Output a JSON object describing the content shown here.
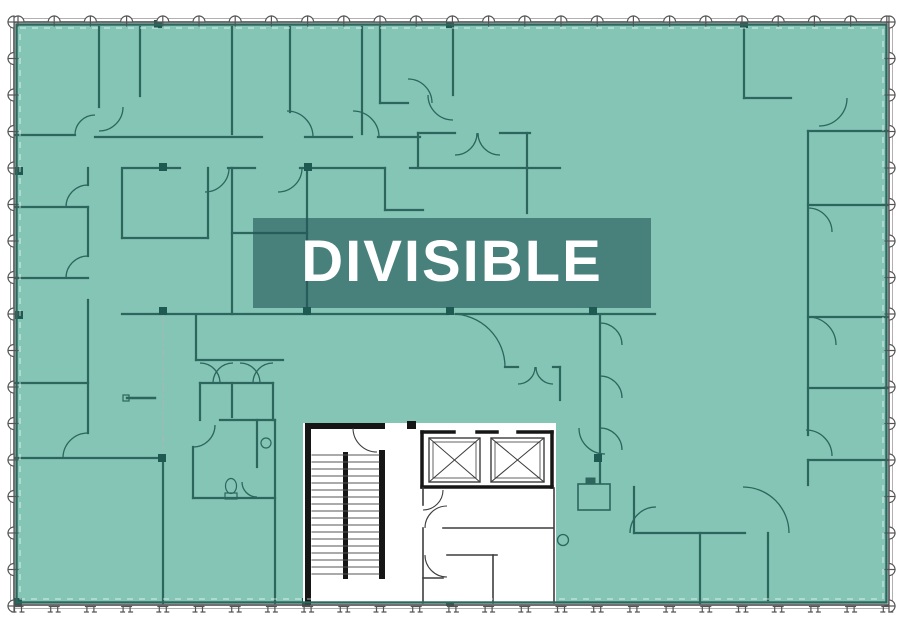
{
  "label": {
    "text": "DIVISIBLE",
    "x": 253,
    "y": 218,
    "w": 398,
    "h": 90
  },
  "colors": {
    "page_bg": "#ffffff",
    "overlay_teal": "#84c5b5",
    "plan_line": "#2c665d",
    "plan_line_strong": "#1f5a52",
    "perimeter_dark": "#4d4d4d",
    "perimeter_light": "#b0b0b0",
    "inner_dash_white": "rgba(255,255,255,0.7)",
    "ref_dash": "#9dbdb6",
    "core_white": "#ffffff",
    "core_wall": "#161616",
    "core_line": "#3d3d3d",
    "label_bg": "rgba(35,85,88,0.62)",
    "label_text": "#ffffff",
    "mullion_stroke": "#555555",
    "mullion_fill": "#ffffff"
  },
  "building": {
    "x": 14,
    "y": 22,
    "w": 875,
    "h": 583
  },
  "core": {
    "x": 303,
    "y": 423,
    "w": 253,
    "h": 180
  },
  "mullions": {
    "top": {
      "fixed": 22,
      "start": 18,
      "step": 36.2,
      "count": 25
    },
    "bottom": {
      "fixed": 605,
      "start": 18,
      "step": 36.2,
      "count": 25
    },
    "left": {
      "fixed": 14,
      "start": 22,
      "step": 36.5,
      "count": 17
    },
    "right": {
      "fixed": 889,
      "start": 22,
      "step": 36.5,
      "count": 17
    }
  },
  "walls": [
    [
      99,
      27,
      99,
      107
    ],
    [
      140,
      27,
      140,
      96
    ],
    [
      232,
      27,
      232,
      134
    ],
    [
      290,
      27,
      290,
      112
    ],
    [
      362,
      27,
      362,
      134
    ],
    [
      380,
      27,
      380,
      103
    ],
    [
      380,
      103,
      408,
      103
    ],
    [
      453,
      27,
      453,
      95
    ],
    [
      95,
      137,
      262,
      137
    ],
    [
      305,
      137,
      352,
      137
    ],
    [
      378,
      137,
      420,
      137
    ],
    [
      122,
      168,
      180,
      168
    ],
    [
      228,
      168,
      255,
      168
    ],
    [
      300,
      168,
      385,
      168
    ],
    [
      410,
      168,
      560,
      168
    ],
    [
      418,
      133,
      455,
      133
    ],
    [
      500,
      133,
      530,
      133
    ],
    [
      418,
      133,
      418,
      168
    ],
    [
      527,
      133,
      527,
      168
    ],
    [
      527,
      168,
      527,
      213
    ],
    [
      385,
      168,
      385,
      210
    ],
    [
      385,
      210,
      423,
      210
    ],
    [
      14,
      135,
      75,
      135
    ],
    [
      88,
      168,
      88,
      185
    ],
    [
      88,
      207,
      88,
      256
    ],
    [
      88,
      300,
      88,
      433
    ],
    [
      14,
      207,
      88,
      207
    ],
    [
      14,
      278,
      88,
      278
    ],
    [
      14,
      383,
      88,
      383
    ],
    [
      14,
      458,
      163,
      458
    ],
    [
      122,
      170,
      122,
      238
    ],
    [
      208,
      168,
      208,
      238
    ],
    [
      122,
      238,
      208,
      238
    ],
    [
      232,
      168,
      232,
      314
    ],
    [
      307,
      168,
      307,
      314
    ],
    [
      232,
      233,
      307,
      233
    ],
    [
      122,
      314,
      448,
      314
    ],
    [
      456,
      314,
      655,
      314
    ],
    [
      163,
      458,
      163,
      603
    ],
    [
      275,
      420,
      275,
      603
    ],
    [
      196,
      316,
      196,
      360
    ],
    [
      196,
      360,
      283,
      360
    ],
    [
      200,
      383,
      273,
      383
    ],
    [
      200,
      383,
      200,
      420
    ],
    [
      232,
      383,
      232,
      417
    ],
    [
      273,
      383,
      273,
      420
    ],
    [
      220,
      420,
      275,
      420
    ],
    [
      193,
      447,
      193,
      498
    ],
    [
      193,
      498,
      275,
      498
    ],
    [
      257,
      420,
      257,
      467
    ],
    [
      505,
      367,
      518,
      367
    ],
    [
      553,
      367,
      560,
      367
    ],
    [
      560,
      367,
      560,
      400
    ],
    [
      600,
      315,
      600,
      483
    ],
    [
      744,
      27,
      744,
      98
    ],
    [
      744,
      98,
      791,
      98
    ],
    [
      808,
      131,
      889,
      131
    ],
    [
      808,
      131,
      808,
      435
    ],
    [
      808,
      205,
      889,
      205
    ],
    [
      808,
      317,
      889,
      317
    ],
    [
      808,
      388,
      889,
      388
    ],
    [
      808,
      460,
      889,
      460
    ],
    [
      808,
      460,
      808,
      485
    ],
    [
      634,
      487,
      634,
      533
    ],
    [
      634,
      533,
      745,
      533
    ],
    [
      700,
      533,
      700,
      603
    ],
    [
      768,
      533,
      768,
      600
    ]
  ],
  "dashed_walls": [
    [
      163,
      316,
      163,
      456
    ],
    [
      310,
      460,
      553,
      460
    ],
    [
      450,
      434,
      450,
      490
    ]
  ],
  "door_arcs": [
    [
      99,
      107,
      24,
      90,
      0
    ],
    [
      95,
      135,
      20,
      180,
      270
    ],
    [
      287,
      137,
      26,
      270,
      0
    ],
    [
      353,
      137,
      26,
      270,
      0
    ],
    [
      205,
      168,
      24,
      0,
      90
    ],
    [
      278,
      168,
      24,
      0,
      90
    ],
    [
      455,
      133,
      22,
      90,
      0
    ],
    [
      500,
      133,
      22,
      90,
      180
    ],
    [
      408,
      103,
      24,
      270,
      0
    ],
    [
      453,
      95,
      25,
      90,
      180
    ],
    [
      88,
      207,
      22,
      180,
      270
    ],
    [
      88,
      278,
      22,
      180,
      270
    ],
    [
      88,
      458,
      25,
      180,
      270
    ],
    [
      452,
      367,
      53,
      270,
      0
    ],
    [
      518,
      367,
      17,
      90,
      0
    ],
    [
      553,
      367,
      17,
      90,
      180
    ],
    [
      600,
      345,
      22,
      270,
      0
    ],
    [
      600,
      398,
      22,
      270,
      0
    ],
    [
      600,
      450,
      22,
      270,
      0
    ],
    [
      377,
      428,
      24,
      180,
      90
    ],
    [
      447,
      528,
      22,
      180,
      270
    ],
    [
      447,
      555,
      22,
      90,
      180
    ],
    [
      605,
      428,
      26,
      90,
      180
    ],
    [
      423,
      490,
      20,
      90,
      0
    ],
    [
      656,
      533,
      26,
      180,
      270
    ],
    [
      743,
      533,
      46,
      270,
      0
    ],
    [
      819,
      98,
      28,
      0,
      90
    ],
    [
      808,
      232,
      24,
      270,
      0
    ],
    [
      808,
      345,
      28,
      270,
      0
    ],
    [
      806,
      456,
      26,
      270,
      0
    ],
    [
      200,
      383,
      20,
      270,
      0
    ],
    [
      233,
      383,
      20,
      180,
      270
    ],
    [
      240,
      383,
      20,
      270,
      0
    ],
    [
      273,
      383,
      20,
      180,
      270
    ],
    [
      193,
      425,
      22,
      0,
      90
    ],
    [
      257,
      482,
      15,
      90,
      180
    ]
  ],
  "column_squares": [
    [
      158,
      24
    ],
    [
      450,
      24
    ],
    [
      744,
      24
    ],
    [
      163,
      167
    ],
    [
      308,
      167
    ],
    [
      163,
      311
    ],
    [
      307,
      311
    ],
    [
      450,
      311
    ],
    [
      593,
      311
    ],
    [
      162,
      458
    ],
    [
      598,
      458
    ],
    [
      19,
      171
    ],
    [
      19,
      315
    ],
    [
      18,
      602
    ],
    [
      306,
      602
    ],
    [
      450,
      602
    ]
  ],
  "core_detail": {
    "black_rects": [
      [
        305,
        423,
        6,
        182
      ],
      [
        305,
        423,
        80,
        6
      ],
      [
        407,
        421,
        9,
        8
      ],
      [
        343,
        452,
        5,
        127
      ],
      [
        379,
        450,
        6,
        129
      ]
    ],
    "treads": {
      "x1": 312,
      "x2": 379,
      "y0": 455,
      "step": 7,
      "count": 18
    },
    "elevator": {
      "top_segments": [
        [
          422,
          432,
          454,
          432
        ],
        [
          477,
          432,
          497,
          432
        ],
        [
          518,
          432,
          552,
          432
        ]
      ],
      "sides": [
        [
          422,
          432,
          422,
          487
        ],
        [
          552,
          432,
          552,
          487
        ],
        [
          422,
          487,
          552,
          487
        ]
      ],
      "cars": [
        [
          429,
          438,
          51,
          44
        ],
        [
          491,
          438,
          53,
          44
        ]
      ]
    },
    "thin_lines": [
      [
        423,
        488,
        423,
        505
      ],
      [
        423,
        528,
        423,
        603
      ],
      [
        443,
        528,
        553,
        528
      ],
      [
        447,
        555,
        497,
        555
      ],
      [
        493,
        555,
        493,
        603
      ],
      [
        423,
        578,
        443,
        578
      ],
      [
        554,
        488,
        554,
        603
      ]
    ]
  },
  "fixtures": {
    "circle_device": [
      563,
      540,
      5.5
    ],
    "ldp_box": [
      578,
      484,
      32,
      26
    ],
    "ldp_top": [
      586,
      478,
      9,
      6
    ],
    "toilet_bowl": [
      231,
      486,
      5.5,
      7.5
    ],
    "toilet_tank": [
      225,
      493,
      12,
      6
    ],
    "sink": [
      266,
      443,
      5
    ],
    "bench_line": [
      127,
      398,
      155,
      398
    ],
    "bench_sq": [
      123,
      395,
      6,
      6
    ]
  }
}
